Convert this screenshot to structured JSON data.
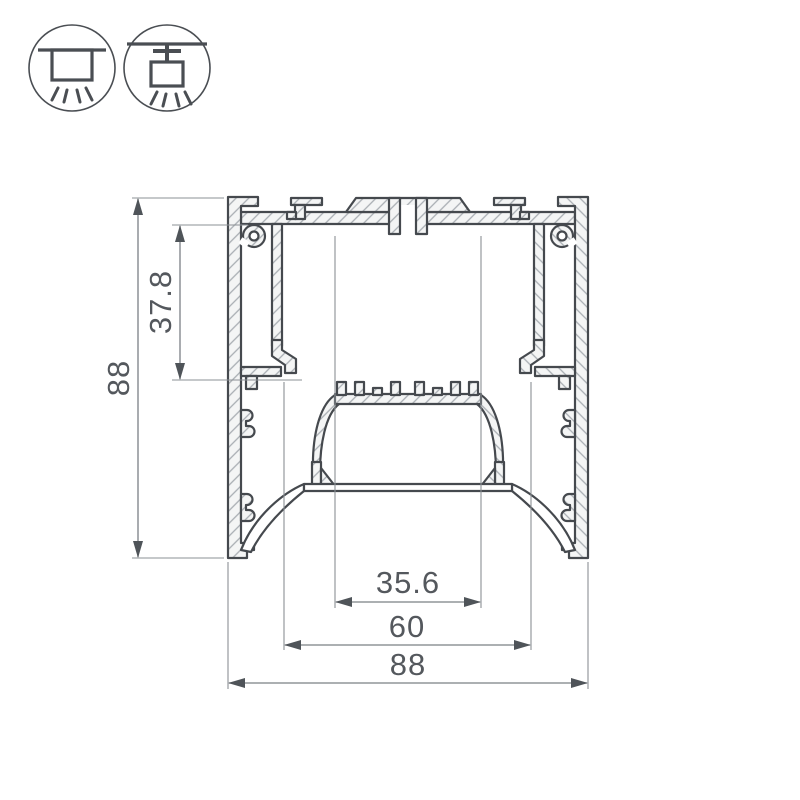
{
  "drawing": {
    "type": "led-profile-cross-section",
    "dimensions": {
      "overall_height": "88",
      "inner_depth": "37.8",
      "plate_width": "35.6",
      "opening_width": "60",
      "overall_width": "88"
    },
    "icons": [
      {
        "name": "surface-mount-icon",
        "meaning": "ceiling surface mounted luminaire"
      },
      {
        "name": "pendant-mount-icon",
        "meaning": "suspended pendant luminaire"
      }
    ],
    "colors": {
      "outline": "#45494e",
      "dimension_text": "#54585d",
      "dimension_line": "#7b8085",
      "hatch": "#a9aeb3",
      "background": "#ffffff"
    }
  }
}
